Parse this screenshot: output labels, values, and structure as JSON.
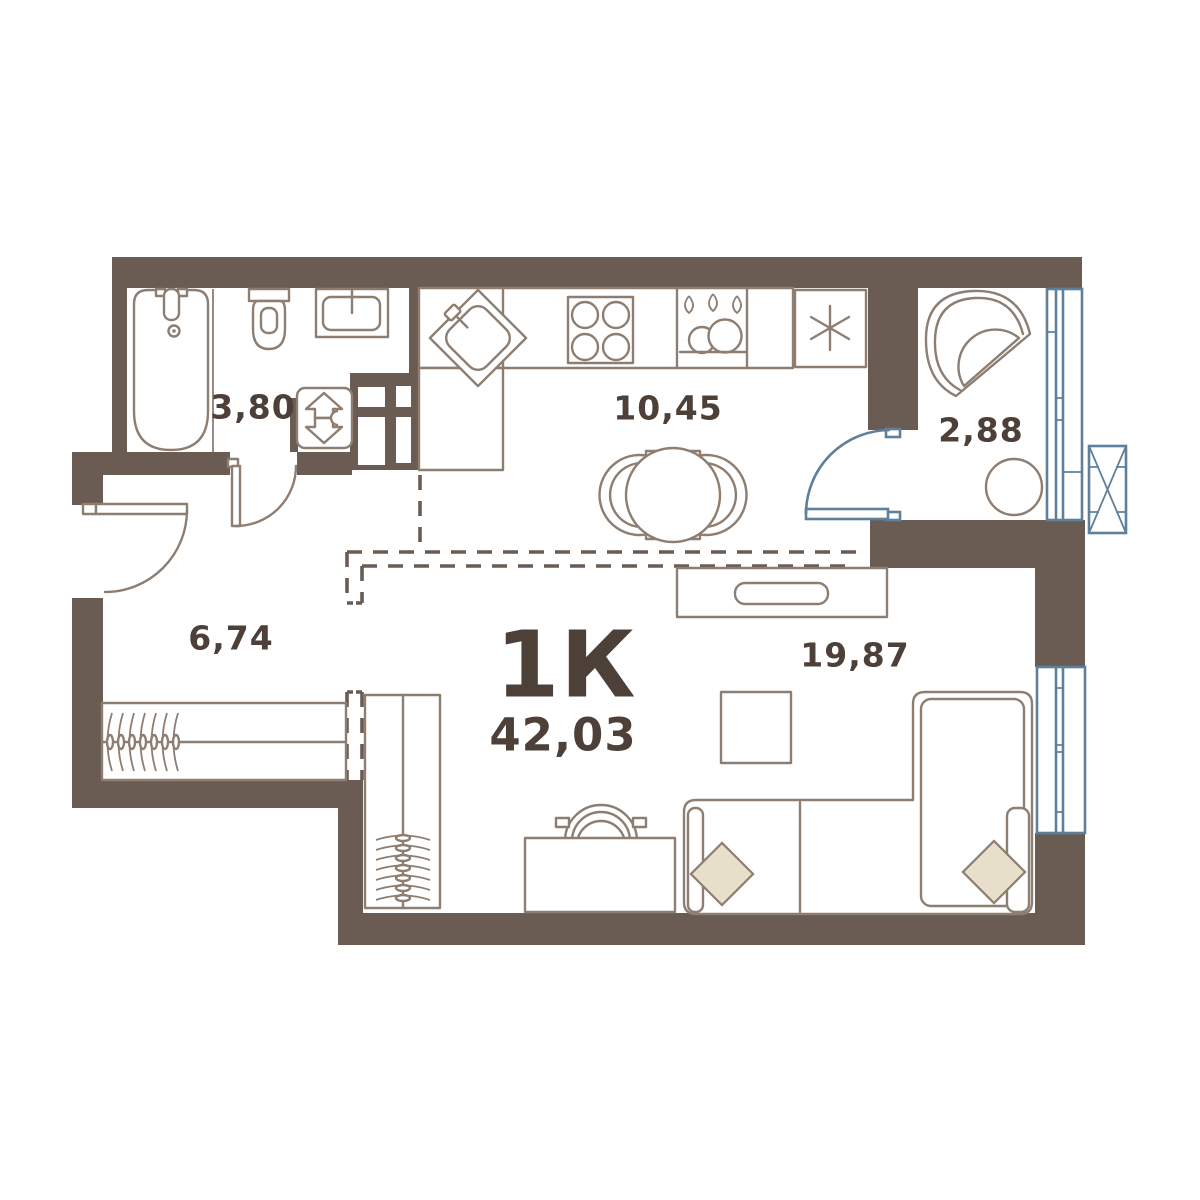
{
  "plan": {
    "type_label": "1К",
    "total_area": "42,03",
    "rooms": [
      {
        "name": "bathroom",
        "area": "3,80"
      },
      {
        "name": "kitchen",
        "area": "10,45"
      },
      {
        "name": "balcony",
        "area": "2,88"
      },
      {
        "name": "hallway",
        "area": "6,74"
      },
      {
        "name": "living-room",
        "area": "19,87"
      }
    ],
    "fixtures": [
      "bathtub-icon",
      "toilet-icon",
      "bathroom-sink-icon",
      "washing-machine-icon",
      "vent-shaft-icon",
      "kitchen-corner-sink-icon",
      "stove-burners-icon",
      "dish-rack-icon",
      "fridge-snowflake-icon",
      "dining-table-icon",
      "dining-chair-icon",
      "entrance-door-arc-icon",
      "bathroom-door-arc-icon",
      "balcony-door-arc-icon",
      "wardrobe-hangers-icon",
      "desk-icon",
      "desk-chair-icon",
      "tv-stand-icon",
      "coffee-table-icon",
      "corner-sofa-icon",
      "sofa-pillow-icon",
      "balcony-armchair-icon",
      "balcony-table-icon",
      "window-icon",
      "balcony-glazing-icon",
      "ac-basket-icon",
      "zone-boundary-dashed-icon"
    ]
  },
  "colors": {
    "wall": "#6a5c52",
    "line": "#8d7e71",
    "accent_blue": "#5e809b",
    "pillow": "#e7dfca",
    "text": "#4d4038",
    "bg": "#ffffff"
  }
}
